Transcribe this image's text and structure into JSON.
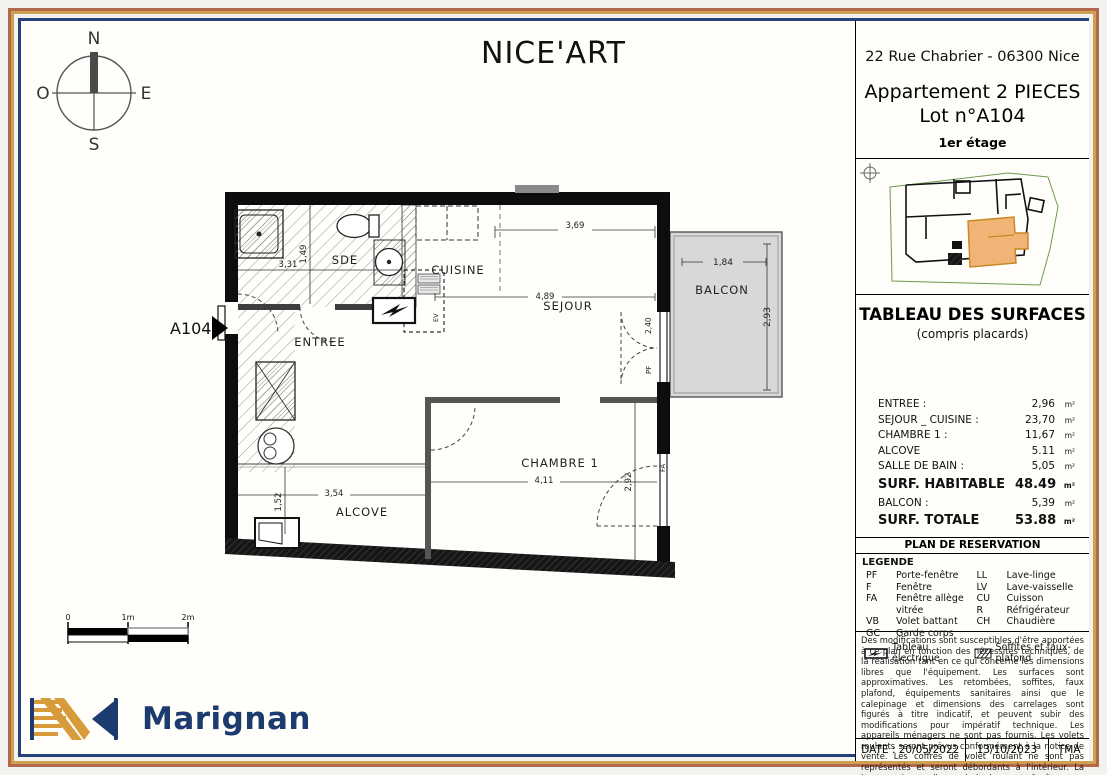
{
  "header": {
    "title": "NICE'ART"
  },
  "title_block": {
    "address": "22 Rue Chabrier - 06300 Nice",
    "apartment": "Appartement 2 PIECES",
    "lot": "Lot n°A104",
    "floor": "1er étage"
  },
  "compass": {
    "north": "N",
    "south": "S",
    "east": "E",
    "west": "O"
  },
  "plan": {
    "unit_label": "A104",
    "rooms": {
      "sde": "SDE",
      "cuisine": "CUISINE",
      "sejour": "SEJOUR",
      "balcon": "BALCON",
      "entree": "ENTREE",
      "chambre": "CHAMBRE 1",
      "alcove": "ALCOVE"
    },
    "dimensions": {
      "sejour_top": "3,69",
      "balcon_width": "1,84",
      "balcon_depth": "2,93",
      "sejour_width": "4,89",
      "sde_width": "3,31",
      "sde_depth": "1,49",
      "window_sejour": "2,40",
      "alcove_width": "3,54",
      "alcove_depth": "1,52",
      "chambre_width": "4,11",
      "chambre_depth": "2,92"
    },
    "tags": {
      "pf": "PF",
      "fa": "FA",
      "ev": "EV"
    }
  },
  "surfaces": {
    "title": "TABLEAU DES SURFACES",
    "subtitle": "(compris placards)",
    "rows": [
      {
        "label": "ENTREE :",
        "value": "2,96",
        "unit": "m²"
      },
      {
        "label": "SEJOUR _ CUISINE :",
        "value": "23,70",
        "unit": "m²"
      },
      {
        "label": "CHAMBRE 1 :",
        "value": "11,67",
        "unit": "m²"
      },
      {
        "label": "ALCOVE",
        "value": "5.11",
        "unit": "m²"
      },
      {
        "label": "SALLE DE BAIN :",
        "value": "5,05",
        "unit": "m²"
      },
      {
        "label": "SURF. HABITABLE",
        "value": "48.49",
        "unit": "m²"
      },
      {
        "label": "BALCON :",
        "value": "5,39",
        "unit": "m²"
      },
      {
        "label": "SURF. TOTALE",
        "value": "53.88",
        "unit": "m²"
      }
    ]
  },
  "reservation": {
    "title": "PLAN DE RESERVATION"
  },
  "legend": {
    "title": "LEGENDE",
    "rows": [
      {
        "l_abbr": "PF",
        "l_name": "Porte-fenêtre",
        "r_abbr": "LL",
        "r_name": "Lave-linge"
      },
      {
        "l_abbr": "F",
        "l_name": "Fenêtre",
        "r_abbr": "LV",
        "r_name": "Lave-vaisselle"
      },
      {
        "l_abbr": "FA",
        "l_name": "Fenêtre allège vitrée",
        "r_abbr": "CU",
        "r_name": "Cuisson"
      },
      {
        "l_abbr": "VB",
        "l_name": "Volet battant",
        "r_abbr": "R",
        "r_name": "Réfrigérateur"
      },
      {
        "l_abbr": "GC",
        "l_name": "Garde corps",
        "r_abbr": "CH",
        "r_name": "Chaudière"
      }
    ],
    "electrical_label": "Tableau électrique",
    "soffits_label": "Soffites et faux-plafond"
  },
  "disclaimer": {
    "text": "Des modifications sont susceptibles d'être apportées à ce plan en fonction des nécessités techniques, de la réalisation tant en ce qui concerne les dimensions libres que l'équipement. Les surfaces sont approximatives. Les retombées, soffites, faux plafond, équipements sanitaires ainsi que le calepinage et dimensions des carrelages sont figurés à titre indicatif, et peuvent subir des modifications pour impératif technique. Les appareils ménagers ne sont pas fournis. Les volets roulants seront prévus conformément à la notice de vente. Les coffres de volet roulant ne sont pas représentés et seront débordants à l'intérieur. La hauteur des seuils au droit des porte-fenêtres sur balcons ou terrasses pourra varier de 5 à 35 cm à partir du sol intérieur. La hauteur entre le jardin et la terrasse pourra varier entre 0 et 60 cm. Les jardins ne seront pas nécessairement plats et pourront comporter des talus et des pentes."
  },
  "footer": {
    "date": "DATE : 20/05/2022",
    "revision": "13/10/2023",
    "code": "TMA"
  },
  "scale_bar": {
    "zero": "0",
    "one": "1m",
    "two": "2m"
  },
  "brand": {
    "name": "Marignan"
  },
  "colors": {
    "frame_terracotta": "#b5674b",
    "frame_gold": "#cda14f",
    "frame_navy": "#24427c",
    "balcony_gray": "#d8d8d8",
    "keyplan_orange": "#f2b377",
    "brand_navy": "#1c3b6e",
    "brand_gold": "#d79b3c"
  }
}
